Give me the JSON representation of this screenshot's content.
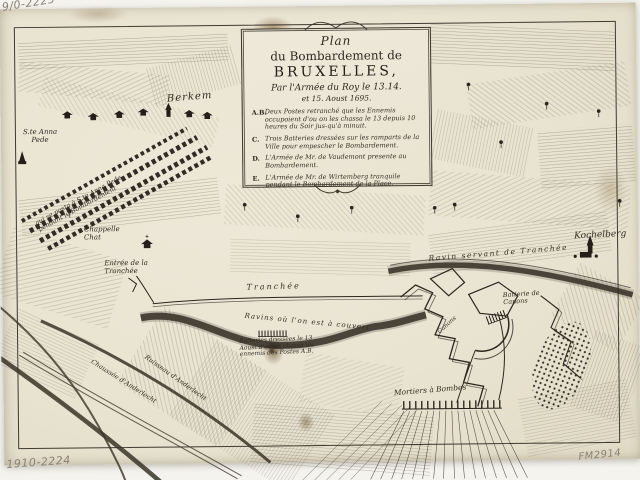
{
  "colors": {
    "paper": "#e9e4d2",
    "ink": "#332d24",
    "stain": "#8a6a3e",
    "pencil": "#8b8173"
  },
  "handwritten": {
    "top_left": "9/0-2225",
    "bottom_left": "1910-2224",
    "bottom_right": "FM2914"
  },
  "cartouche": {
    "title": [
      "Plan",
      "du Bombardement de",
      "BRUXELLES,",
      "Par l'Armée du Roy le 13.14.",
      "et 15. Aoust 1695."
    ],
    "legend": [
      {
        "key": "A.B.",
        "text": "Deux Postes retranché que les Ennemis occupoient d'ou on les chassa le 13 depuis 10 heures du Soir jus-qu'à minuit."
      },
      {
        "key": "C.",
        "text": "Trois Batteries dressées sur les ramparts de la Ville pour empescher le Bombardement."
      },
      {
        "key": "D.",
        "text": "L'Armée de Mr. de Vaudemont presente au Bombardement."
      },
      {
        "key": "E.",
        "text": "L'Armée de Mr. de Wirtemberg tranquile pendant le Bombardement de la Place."
      }
    ]
  },
  "labels": {
    "berkem": "Berkem",
    "ste_anna_pede": "S.te Anna\nPede",
    "camp_note": "qui se posta à S.te Anna Pede\npendant le Bombardement",
    "chappelle_chat": "Chappelle\nChat",
    "entree_tranchee": "Entrée de la\nTranchée",
    "tranchee": "Tranchée",
    "ravins_couvert": "Ravins où l'on est à couvert",
    "batterie_13": "Batteries dressées le 13\nAoust d'ou on chassa les\nennemis des Postes A.B.",
    "ravin_servant": "Ravin servant de Tranchée",
    "kochelberg": "Kochelberg",
    "batterie_canons": "Batterie de\nCanons",
    "batterie_canons_2": "Canons",
    "mortiers": "Mortiers à Bombes",
    "chaussee": "Chaussée d'Anderlecht",
    "ruisseau": "Ruisseau d'Anderlecht"
  }
}
